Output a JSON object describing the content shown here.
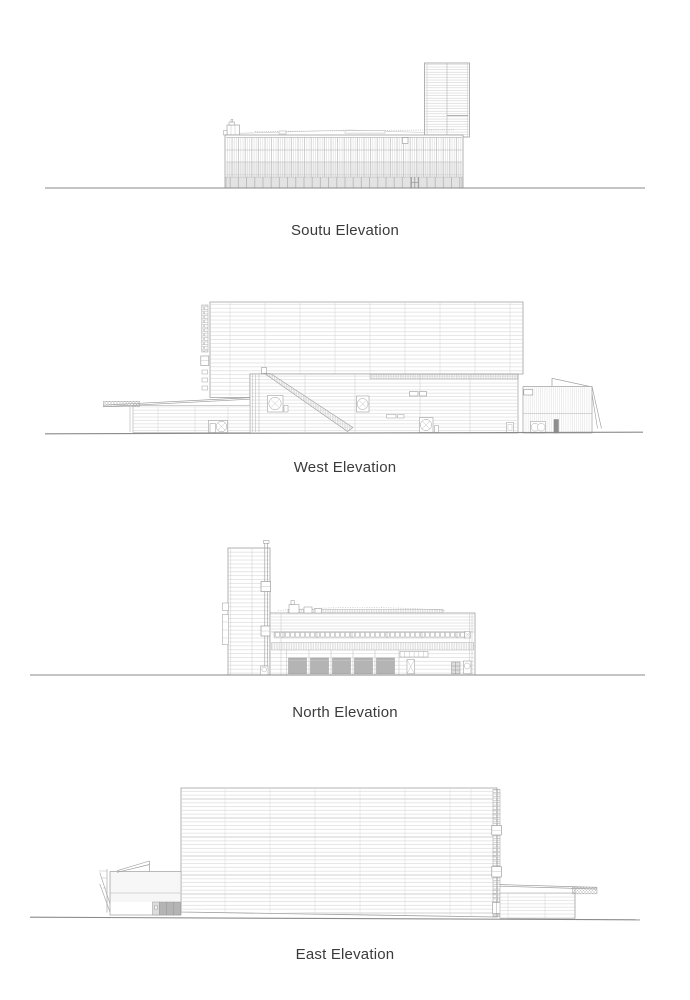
{
  "document": {
    "background": "#ffffff",
    "text_color": "#3b3b3b",
    "line_color_light": "#c9c9c9",
    "line_color_medium": "#a0a0a0",
    "line_color_dark": "#8a8a8a",
    "door_fill": "#b4b4b4",
    "base_fill": "#e3e3e3"
  },
  "elevations": [
    {
      "id": "south",
      "caption": "Soutu Elevation"
    },
    {
      "id": "west",
      "caption": "West Elevation"
    },
    {
      "id": "north",
      "caption": "North Elevation"
    },
    {
      "id": "east",
      "caption": "East Elevation"
    }
  ]
}
